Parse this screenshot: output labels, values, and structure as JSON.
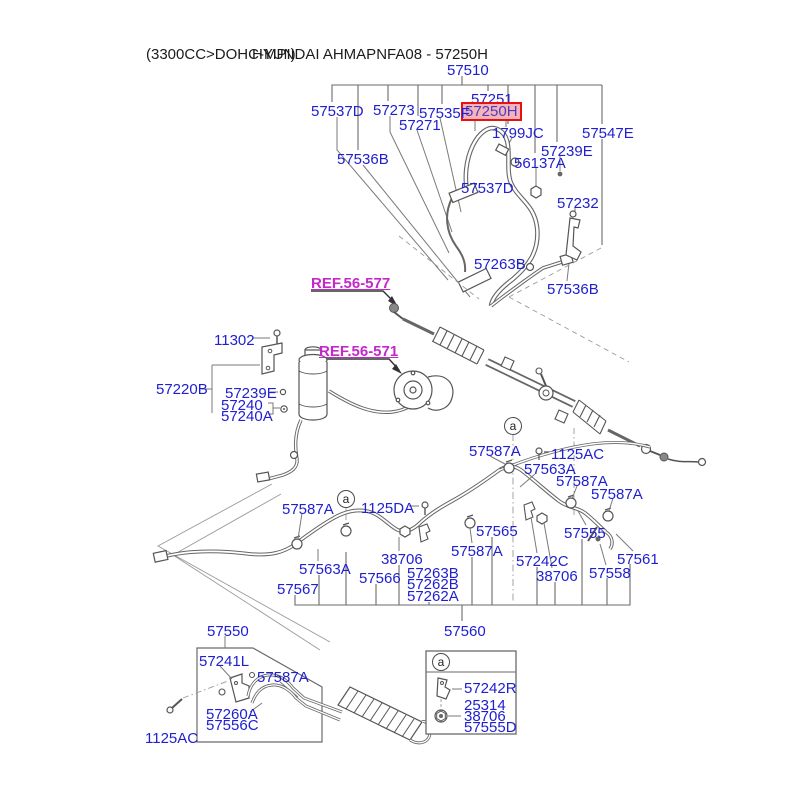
{
  "title": {
    "left": "(3300CC>DOHC-MPI)",
    "right": "HYUNDAI AHMAPNFA08 - 57250H"
  },
  "colors": {
    "part_label": "#2020d0",
    "ref_link": "#c328c9",
    "highlight_border": "#e81010",
    "highlight_fill": "#f6b4ba",
    "line_art": "#686868"
  },
  "highlighted_part": "57250H",
  "labels": [
    {
      "text": "57510",
      "x": 447,
      "y": 63
    },
    {
      "text": "57251",
      "x": 471,
      "y": 92
    },
    {
      "text": "57250H",
      "x": 464,
      "y": 104,
      "highlight": true
    },
    {
      "text": "57537D",
      "x": 311,
      "y": 104
    },
    {
      "text": "57273",
      "x": 373,
      "y": 103
    },
    {
      "text": "57535F",
      "x": 419,
      "y": 106
    },
    {
      "text": "57271",
      "x": 399,
      "y": 118
    },
    {
      "text": "1799JC",
      "x": 492,
      "y": 126
    },
    {
      "text": "57547E",
      "x": 582,
      "y": 126
    },
    {
      "text": "57239E",
      "x": 541,
      "y": 144
    },
    {
      "text": "56137A",
      "x": 514,
      "y": 156
    },
    {
      "text": "57536B",
      "x": 337,
      "y": 152
    },
    {
      "text": "57537D",
      "x": 461,
      "y": 181
    },
    {
      "text": "57232",
      "x": 557,
      "y": 196
    },
    {
      "text": "57263B",
      "x": 474,
      "y": 257
    },
    {
      "text": "57536B",
      "x": 547,
      "y": 282
    },
    {
      "text": "REF.56-577",
      "x": 311,
      "y": 276,
      "type": "ref"
    },
    {
      "text": "11302",
      "x": 214,
      "y": 333
    },
    {
      "text": "REF.56-571",
      "x": 319,
      "y": 344,
      "type": "ref"
    },
    {
      "text": "57220B",
      "x": 156,
      "y": 382
    },
    {
      "text": "57239E",
      "x": 225,
      "y": 386
    },
    {
      "text": "57240",
      "x": 221,
      "y": 398
    },
    {
      "text": "57240A",
      "x": 221,
      "y": 409
    },
    {
      "text": "57587A",
      "x": 469,
      "y": 444
    },
    {
      "text": "1125AC",
      "x": 551,
      "y": 447
    },
    {
      "text": "57563A",
      "x": 524,
      "y": 462
    },
    {
      "text": "57587A",
      "x": 556,
      "y": 474
    },
    {
      "text": "57587A",
      "x": 591,
      "y": 487
    },
    {
      "text": "57587A",
      "x": 282,
      "y": 502
    },
    {
      "text": "1125DA",
      "x": 361,
      "y": 501
    },
    {
      "text": "57565",
      "x": 476,
      "y": 524
    },
    {
      "text": "57555",
      "x": 564,
      "y": 526
    },
    {
      "text": "57587A",
      "x": 451,
      "y": 544
    },
    {
      "text": "57242C",
      "x": 516,
      "y": 554
    },
    {
      "text": "57561",
      "x": 617,
      "y": 552
    },
    {
      "text": "38706",
      "x": 381,
      "y": 552
    },
    {
      "text": "57563A",
      "x": 299,
      "y": 562
    },
    {
      "text": "57263B",
      "x": 407,
      "y": 566
    },
    {
      "text": "57558",
      "x": 589,
      "y": 566
    },
    {
      "text": "38706",
      "x": 536,
      "y": 569
    },
    {
      "text": "57566",
      "x": 359,
      "y": 571
    },
    {
      "text": "57262B",
      "x": 407,
      "y": 577
    },
    {
      "text": "57567",
      "x": 277,
      "y": 582
    },
    {
      "text": "57262A",
      "x": 407,
      "y": 589
    },
    {
      "text": "57550",
      "x": 207,
      "y": 624
    },
    {
      "text": "57560",
      "x": 444,
      "y": 624
    },
    {
      "text": "57241L",
      "x": 199,
      "y": 654
    },
    {
      "text": "57587A",
      "x": 257,
      "y": 670
    },
    {
      "text": "57260A",
      "x": 206,
      "y": 707
    },
    {
      "text": "57556C",
      "x": 206,
      "y": 718
    },
    {
      "text": "1125AC",
      "x": 145,
      "y": 731
    },
    {
      "text": "57242R",
      "x": 464,
      "y": 681
    },
    {
      "text": "25314",
      "x": 464,
      "y": 698
    },
    {
      "text": "38706",
      "x": 464,
      "y": 709
    },
    {
      "text": "57555D",
      "x": 464,
      "y": 720
    }
  ],
  "markers": [
    {
      "text": "a",
      "x": 513,
      "y": 426
    },
    {
      "text": "a",
      "x": 346,
      "y": 499
    },
    {
      "text": "a",
      "x": 441,
      "y": 662
    }
  ]
}
